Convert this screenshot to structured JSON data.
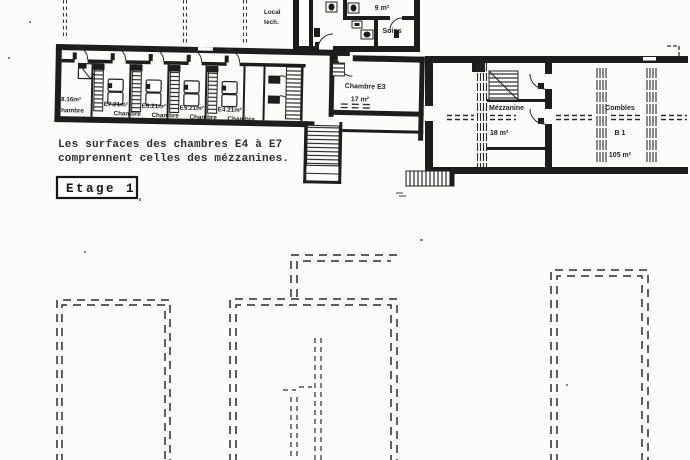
{
  "plan": {
    "floor_tag": "Etage 1",
    "note_lines": [
      "Les surfaces des chambres E4 à E7",
      "comprennent celles des mézzanines."
    ],
    "upper": {
      "top_rooms": {
        "area_9": "9 m²",
        "soins": "Soins",
        "local_tech_line1": "Local",
        "local_tech_line2": "tech."
      },
      "left_wing_rooms": [
        {
          "code": "E8.16m²",
          "name": "Chambre"
        },
        {
          "code": "E7.21m²",
          "name": "Chambre"
        },
        {
          "code": "E6.21m²",
          "name": "Chambre"
        },
        {
          "code": "E5.21m²",
          "name": "Chambre"
        },
        {
          "code": "E4.21m²",
          "name": "Chambre"
        }
      ],
      "e3": {
        "name": "Chambre E3",
        "area": "17 m²"
      },
      "mezzanine": {
        "name": "Mézzanine",
        "area": "18 m²"
      },
      "combles": {
        "name": "Combles",
        "code": "B 1",
        "area": "105 m²"
      }
    },
    "ink": "#1d1d1d",
    "paper": "#fcfcfa"
  }
}
